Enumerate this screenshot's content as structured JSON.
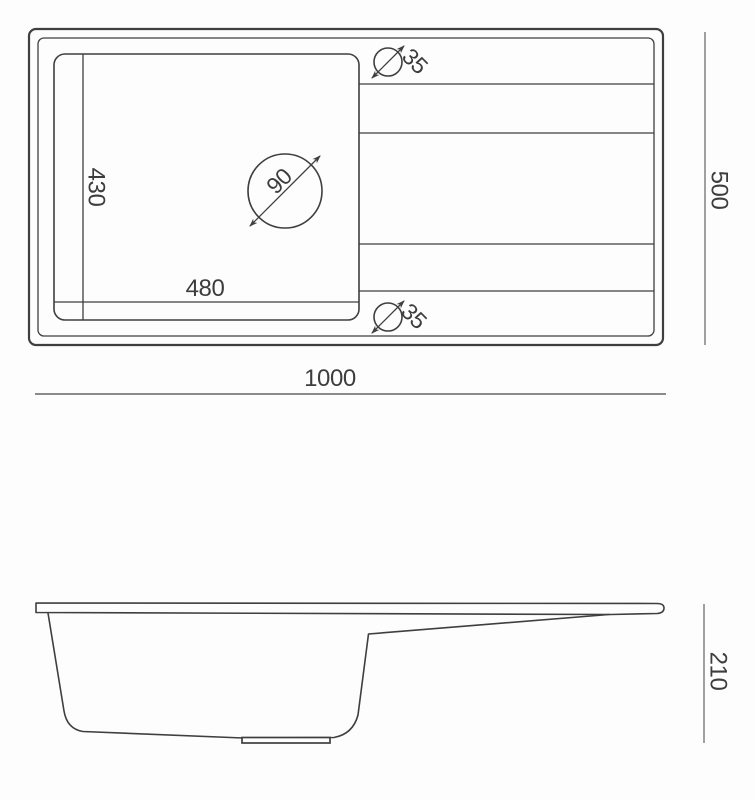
{
  "top_view": {
    "overall_width": "1000",
    "overall_depth": "500",
    "bowl_width": "480",
    "bowl_depth": "430",
    "faucet_hole_diameter": "90",
    "drain_hole_top_diameter": "35",
    "drain_hole_bottom_diameter": "35"
  },
  "side_view": {
    "overall_height": "210"
  },
  "colors": {
    "line": "#3f3f3f",
    "dim_line": "#8a8a8a",
    "dim_line_dark": "#6e6e6e",
    "text": "#3d3d3d",
    "background": "#fdfdfd"
  }
}
